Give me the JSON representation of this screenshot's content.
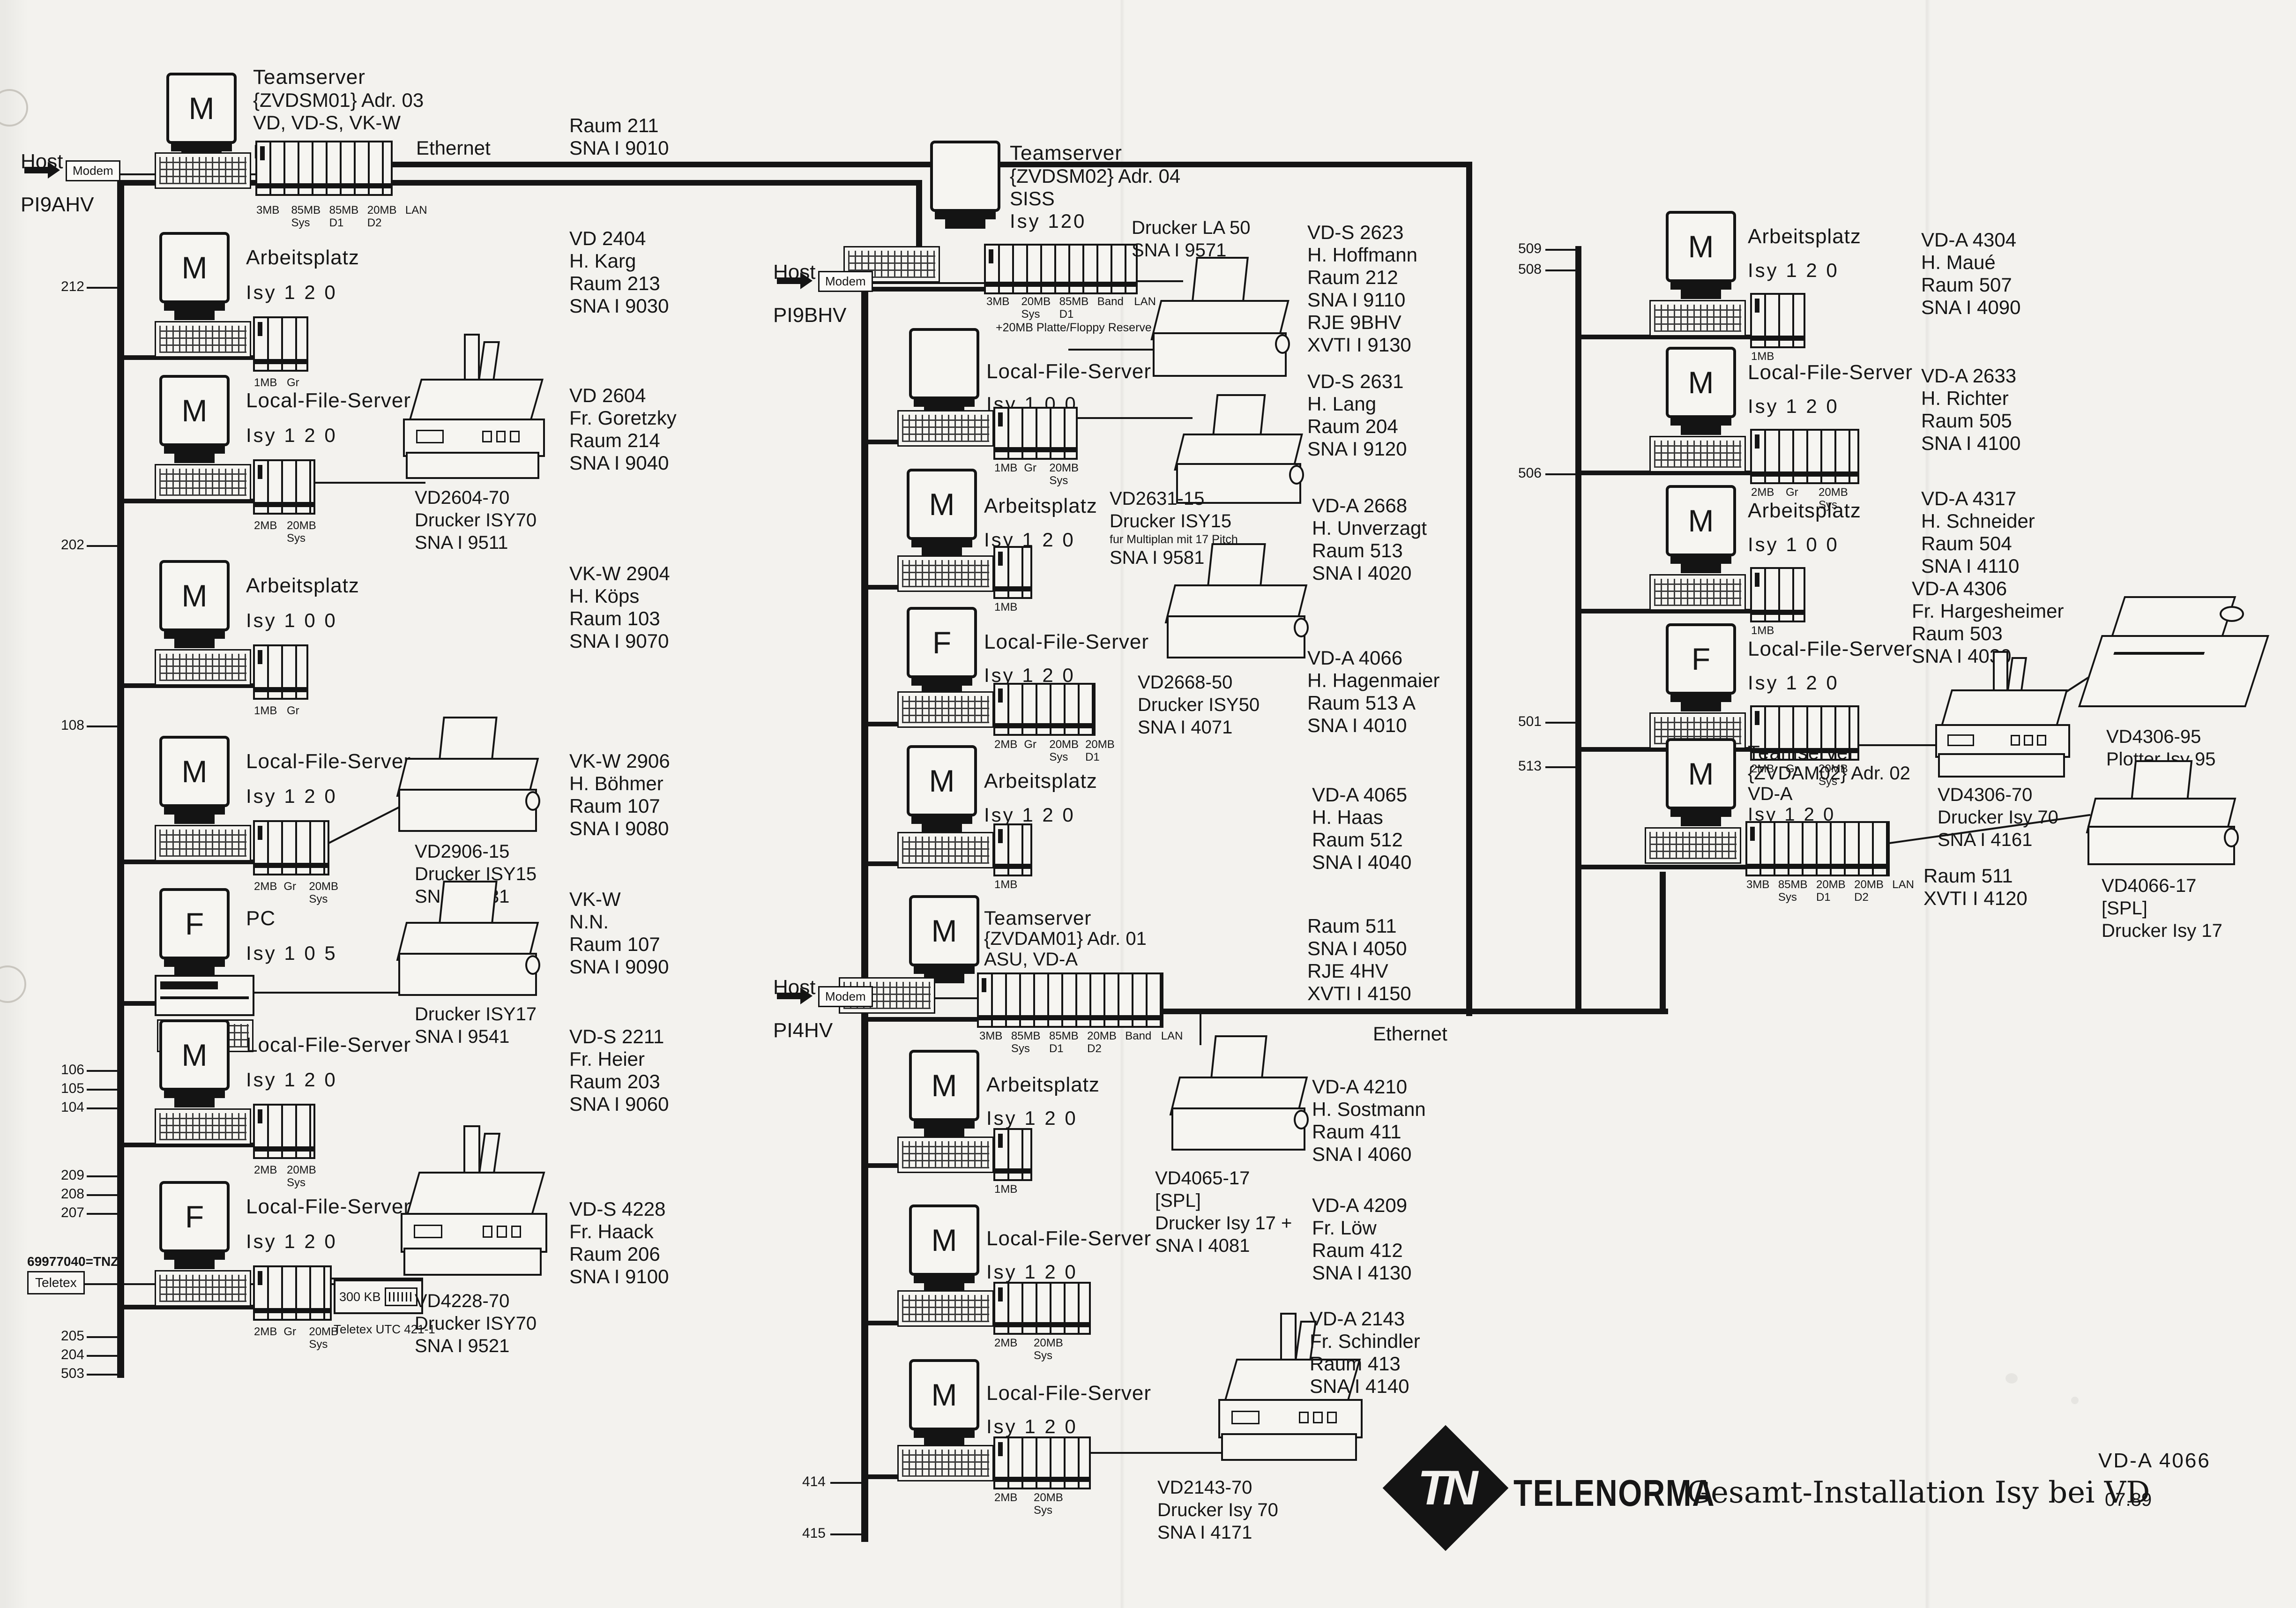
{
  "labels": {
    "ethernet": "Ethernet"
  },
  "hosts": [
    {
      "label": "Host",
      "device": "Modem",
      "name": "PI9AHV"
    },
    {
      "label": "Host",
      "device": "Modem",
      "name": "PI9BHV"
    },
    {
      "label": "Host",
      "device": "Modem",
      "name": "PI4HV"
    }
  ],
  "teletex": {
    "id": "69977040=TNZ",
    "box": "Teletex",
    "module": "300 KB",
    "module_label": "Teletex UTC 421-1"
  },
  "nodes": {
    "ts1": {
      "mon": "M",
      "label": "Teamserver",
      "sub1": "{ZVDSM01} Adr. 03",
      "sub2": "VD, VD-S, VK-W",
      "isy": "Isy 1 2 0",
      "slots": [
        {
          "t": "3MB",
          "b": ""
        },
        {
          "t": "85MB",
          "b": "Sys"
        },
        {
          "t": "85MB",
          "b": "D1"
        },
        {
          "t": "20MB",
          "b": "D2"
        },
        {
          "t": "LAN",
          "b": ""
        }
      ]
    },
    "l1": {
      "mon": "M",
      "label": "Arbeitsplatz",
      "isy": "Isy 1 2 0",
      "slots": [
        {
          "t": "1MB",
          "b": ""
        },
        {
          "t": "Gr",
          "b": ""
        }
      ]
    },
    "l2": {
      "mon": "M",
      "label": "Local-File-Server",
      "isy": "Isy 1 2 0",
      "slots": [
        {
          "t": "2MB",
          "b": ""
        },
        {
          "t": "20MB",
          "b": "Sys"
        }
      ]
    },
    "l3": {
      "mon": "M",
      "label": "Arbeitsplatz",
      "isy": "Isy 1 0 0",
      "slots": [
        {
          "t": "1MB",
          "b": ""
        },
        {
          "t": "Gr",
          "b": ""
        }
      ]
    },
    "l4": {
      "mon": "M",
      "label": "Local-File-Server",
      "isy": "Isy 1 2 0",
      "slots": [
        {
          "t": "2MB",
          "b": ""
        },
        {
          "t": "Gr",
          "b": ""
        },
        {
          "t": "20MB",
          "b": "Sys"
        }
      ]
    },
    "l5": {
      "mon": "F",
      "label": "PC",
      "isy": "Isy 1 0 5",
      "slots": []
    },
    "l6": {
      "mon": "M",
      "label": "Local-File-Server",
      "isy": "Isy 1 2 0",
      "slots": [
        {
          "t": "2MB",
          "b": ""
        },
        {
          "t": "20MB",
          "b": "Sys"
        }
      ]
    },
    "l7": {
      "mon": "F",
      "label": "Local-File-Server",
      "isy": "Isy 1 2 0",
      "slots": [
        {
          "t": "2MB",
          "b": ""
        },
        {
          "t": "Gr",
          "b": ""
        },
        {
          "t": "20MB",
          "b": "Sys"
        }
      ]
    },
    "m0": {
      "mon": "",
      "label": "Teamserver",
      "sub1": "{ZVDSM02} Adr. 04",
      "sub2": "SISS",
      "isy": "Isy 120",
      "slots": [
        {
          "t": "3MB",
          "b": ""
        },
        {
          "t": "20MB",
          "b": "Sys"
        },
        {
          "t": "85MB",
          "b": "D1"
        },
        {
          "t": "Band",
          "b": ""
        },
        {
          "t": "LAN",
          "b": ""
        }
      ],
      "extra": "+20MB Platte/Floppy Reserve"
    },
    "m1": {
      "mon": "",
      "label": "Local-File-Server",
      "isy": "Isy 1 0 0",
      "slots": [
        {
          "t": "1MB",
          "b": ""
        },
        {
          "t": "Gr",
          "b": ""
        },
        {
          "t": "20MB",
          "b": "Sys"
        }
      ]
    },
    "m2": {
      "mon": "M",
      "label": "Arbeitsplatz",
      "isy": "Isy 1 2 0",
      "slots": [
        {
          "t": "1MB",
          "b": ""
        }
      ]
    },
    "m3": {
      "mon": "F",
      "label": "Local-File-Server",
      "isy": "Isy 1 2 0",
      "slots": [
        {
          "t": "2MB",
          "b": ""
        },
        {
          "t": "Gr",
          "b": ""
        },
        {
          "t": "20MB",
          "b": "Sys"
        },
        {
          "t": "20MB",
          "b": "D1"
        }
      ]
    },
    "m4": {
      "mon": "M",
      "label": "Arbeitsplatz",
      "isy": "Isy 1 2 0",
      "slots": [
        {
          "t": "1MB",
          "b": ""
        }
      ]
    },
    "m5": {
      "mon": "M",
      "label": "Teamserver",
      "sub1": "{ZVDAM01} Adr. 01",
      "sub2": "ASU, VD-A",
      "isy": "Isy 1 2 0",
      "slots": [
        {
          "t": "3MB",
          "b": ""
        },
        {
          "t": "85MB",
          "b": "Sys"
        },
        {
          "t": "85MB",
          "b": "D1"
        },
        {
          "t": "20MB",
          "b": "D2"
        },
        {
          "t": "Band",
          "b": ""
        },
        {
          "t": "LAN",
          "b": ""
        }
      ]
    },
    "m6": {
      "mon": "M",
      "label": "Arbeitsplatz",
      "isy": "Isy 1 2 0",
      "slots": [
        {
          "t": "1MB",
          "b": ""
        }
      ]
    },
    "m7": {
      "mon": "M",
      "label": "Local-File-Server",
      "isy": "Isy 1 2 0",
      "slots": [
        {
          "t": "2MB",
          "b": ""
        },
        {
          "t": "20MB",
          "b": "Sys"
        }
      ]
    },
    "m8": {
      "mon": "M",
      "label": "Local-File-Server",
      "isy": "Isy 1 2 0",
      "slots": [
        {
          "t": "2MB",
          "b": ""
        },
        {
          "t": "20MB",
          "b": "Sys"
        }
      ]
    },
    "r1": {
      "mon": "M",
      "label": "Arbeitsplatz",
      "isy": "Isy 1 2 0",
      "slots": [
        {
          "t": "1MB",
          "b": ""
        }
      ]
    },
    "r2": {
      "mon": "M",
      "label": "Local-File-Server",
      "isy": "Isy 1 2 0",
      "slots": [
        {
          "t": "2MB",
          "b": ""
        },
        {
          "t": "Gr",
          "b": ""
        },
        {
          "t": "20MB",
          "b": "Sys"
        }
      ]
    },
    "r3": {
      "mon": "M",
      "label": "Arbeitsplatz",
      "isy": "Isy 1 0 0",
      "slots": [
        {
          "t": "1MB",
          "b": ""
        }
      ]
    },
    "r4": {
      "mon": "F",
      "label": "Local-File-Server",
      "isy": "Isy 1 2 0",
      "slots": [
        {
          "t": "2MB",
          "b": ""
        },
        {
          "t": "Gr",
          "b": ""
        },
        {
          "t": "20MB",
          "b": "Sys"
        }
      ]
    },
    "r5": {
      "mon": "M",
      "label": "Teamserver",
      "sub1": "{ZVDAM02} Adr. 02",
      "sub2": "VD-A",
      "isy": "Isy 1 2 0",
      "slots": [
        {
          "t": "3MB",
          "b": ""
        },
        {
          "t": "85MB",
          "b": "Sys"
        },
        {
          "t": "20MB",
          "b": "D1"
        },
        {
          "t": "20MB",
          "b": "D2"
        },
        {
          "t": "LAN",
          "b": ""
        }
      ]
    }
  },
  "printers": {
    "p_la50": [
      "Drucker LA 50",
      "SNA I 9571"
    ],
    "p2604": [
      "VD2604-70",
      "Drucker ISY70",
      "SNA I 9511"
    ],
    "p2906": [
      "VD2906-15",
      "Drucker ISY15",
      "SNA I 9531"
    ],
    "p_isy17": [
      "Drucker ISY17",
      "SNA I 9541"
    ],
    "p4228": [
      "VD4228-70",
      "Drucker ISY70",
      "SNA I 9521"
    ],
    "p2631": [
      "VD2631-15",
      "Drucker ISY15",
      "fur Multiplan mit 17 Pitch",
      "SNA I 9581"
    ],
    "p2668": [
      "VD2668-50",
      "Drucker ISY50",
      "SNA I 4071"
    ],
    "p4065": [
      "VD4065-17",
      "[SPL]",
      "Drucker Isy 17 +",
      "SNA I 4081"
    ],
    "p2143": [
      "VD2143-70",
      "Drucker Isy 70",
      "SNA I 4171"
    ],
    "p4306_95": [
      "VD4306-95",
      "Plotter Isy 95"
    ],
    "p4306_70": [
      "VD4306-70",
      "Drucker Isy 70",
      "SNA I 4161"
    ],
    "p4066_17": [
      "VD4066-17",
      "[SPL]",
      "Drucker Isy 17"
    ]
  },
  "infos": {
    "i_211": [
      "Raum 211",
      "SNA I 9010"
    ],
    "i2404": [
      "VD 2404",
      "H. Karg",
      "Raum 213",
      "SNA I 9030"
    ],
    "i2604": [
      "VD 2604",
      "Fr. Goretzky",
      "Raum 214",
      "SNA I 9040"
    ],
    "i2904": [
      "VK-W 2904",
      "H. Köps",
      "Raum 103",
      "SNA I 9070"
    ],
    "i2906": [
      "VK-W 2906",
      "H. Böhmer",
      "Raum 107",
      "SNA I 9080"
    ],
    "i_nn": [
      "VK-W",
      "N.N.",
      "Raum 107",
      "SNA I 9090"
    ],
    "i2211": [
      "VD-S 2211",
      "Fr. Heier",
      "Raum 203",
      "SNA I 9060"
    ],
    "i4228": [
      "VD-S 4228",
      "Fr. Haack",
      "Raum 206",
      "SNA I 9100"
    ],
    "i2623": [
      "VD-S 2623",
      "H. Hoffmann",
      "Raum 212",
      "SNA I 9110",
      "RJE  9BHV",
      "XVTI I 9130"
    ],
    "i2631": [
      "VD-S 2631",
      "H. Lang",
      "Raum 204",
      "SNA I 9120"
    ],
    "i2668": [
      "VD-A 2668",
      "H. Unverzagt",
      "Raum 513",
      "SNA I 4020"
    ],
    "i4066": [
      "VD-A 4066",
      "H. Hagenmaier",
      "Raum 513 A",
      "SNA I 4010"
    ],
    "i4065": [
      "VD-A 4065",
      "H. Haas",
      "Raum 512",
      "SNA I 4040"
    ],
    "i_511a": [
      "Raum 511",
      "SNA I 4050",
      "RJE  4HV",
      "XVTI I 4150"
    ],
    "i4210": [
      "VD-A 4210",
      "H. Sostmann",
      "Raum 411",
      "SNA I 4060"
    ],
    "i4209": [
      "VD-A 4209",
      "Fr. Löw",
      "Raum 412",
      "SNA I 4130"
    ],
    "i2143": [
      "VD-A 2143",
      "Fr. Schindler",
      "Raum 413",
      "SNA I 4140"
    ],
    "i4304": [
      "VD-A 4304",
      "H. Maué",
      "Raum 507",
      "SNA I 4090"
    ],
    "i2633": [
      "VD-A 2633",
      "H. Richter",
      "Raum 505",
      "SNA I 4100"
    ],
    "i4317": [
      "VD-A 4317",
      "H. Schneider",
      "Raum 504",
      "SNA I 4110"
    ],
    "i4306": [
      "VD-A 4306",
      "Fr. Hargesheimer",
      "Raum 503",
      "SNA I 4030"
    ],
    "i_511b": [
      "Raum 511",
      "XVTI I 4120"
    ]
  },
  "stubs": {
    "left": [
      "212",
      "202",
      "108",
      "106",
      "105",
      "104",
      "209",
      "208",
      "207",
      "205",
      "204",
      "503"
    ],
    "middle": [
      "414",
      "415"
    ],
    "right": [
      "509",
      "508",
      "506",
      "501",
      "513"
    ]
  },
  "footer": {
    "logo": "TN",
    "brand": "TELENORMA",
    "title": "Gesamt-Installation Isy bei VD",
    "doc_no": "VD-A 4066",
    "date": "07.89"
  }
}
